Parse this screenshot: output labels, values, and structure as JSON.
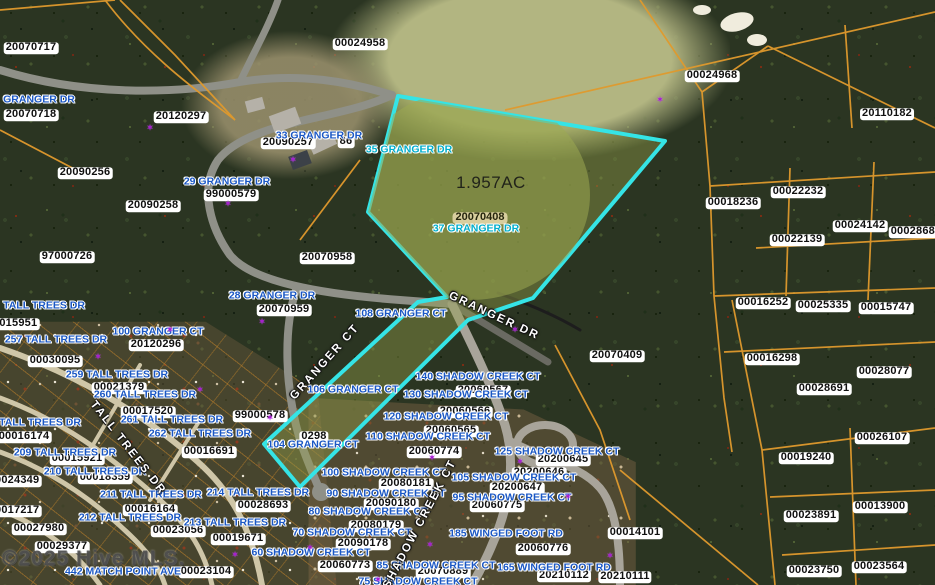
{
  "map": {
    "watermark": "©2025 Hive MLS.",
    "subject_parcel": {
      "id": "20070408",
      "address": "37 GRANGER DR",
      "area": "1.957AC",
      "id_x": 480,
      "id_y": 218,
      "addr_x": 476,
      "addr_y": 229,
      "area_x": 491,
      "area_y": 183
    },
    "colors": {
      "subject_boundary": "#35e4e6",
      "subject_id_pill": "#d8ce9e",
      "parcel_lines": "#e09a2d",
      "address_text": "#1a57c4",
      "teal_address_text": "#00aecc",
      "marker": "#a81ad2"
    },
    "icons": {
      "marker": "✶"
    },
    "parcel_labels": [
      {
        "t": "20070717",
        "x": 31,
        "y": 48
      },
      {
        "t": "00024958",
        "x": 360,
        "y": 44
      },
      {
        "t": "00024968",
        "x": 712,
        "y": 76
      },
      {
        "t": "20110182",
        "x": 887,
        "y": 114
      },
      {
        "t": "20070718",
        "x": 31,
        "y": 115
      },
      {
        "t": "20120297",
        "x": 181,
        "y": 117
      },
      {
        "t": "20090257",
        "x": 288,
        "y": 143
      },
      {
        "t": "86",
        "x": 346,
        "y": 142
      },
      {
        "t": "20090256",
        "x": 85,
        "y": 173
      },
      {
        "t": "20090258",
        "x": 153,
        "y": 206
      },
      {
        "t": "99000579",
        "x": 231,
        "y": 195
      },
      {
        "t": "97000726",
        "x": 67,
        "y": 257
      },
      {
        "t": "00022232",
        "x": 798,
        "y": 192
      },
      {
        "t": "00018236",
        "x": 733,
        "y": 203
      },
      {
        "t": "00024142",
        "x": 860,
        "y": 226
      },
      {
        "t": "00028689",
        "x": 916,
        "y": 232
      },
      {
        "t": "00022139",
        "x": 797,
        "y": 240
      },
      {
        "t": "20070958",
        "x": 327,
        "y": 258
      },
      {
        "t": "20070959",
        "x": 284,
        "y": 310
      },
      {
        "t": "00016252",
        "x": 763,
        "y": 303
      },
      {
        "t": "00025335",
        "x": 823,
        "y": 306
      },
      {
        "t": "00015747",
        "x": 886,
        "y": 308
      },
      {
        "t": "00015951",
        "x": 12,
        "y": 324
      },
      {
        "t": "20120296",
        "x": 156,
        "y": 345
      },
      {
        "t": "00030095",
        "x": 55,
        "y": 361
      },
      {
        "t": "20070409",
        "x": 617,
        "y": 356
      },
      {
        "t": "00016298",
        "x": 772,
        "y": 359
      },
      {
        "t": "00028077",
        "x": 884,
        "y": 372
      },
      {
        "t": "00021379",
        "x": 119,
        "y": 388
      },
      {
        "t": "00028691",
        "x": 824,
        "y": 389
      },
      {
        "t": "20060567",
        "x": 483,
        "y": 391
      },
      {
        "t": "00017520",
        "x": 148,
        "y": 412
      },
      {
        "t": "20060566",
        "x": 465,
        "y": 412
      },
      {
        "t": "99000578",
        "x": 260,
        "y": 416
      },
      {
        "t": "20060565",
        "x": 451,
        "y": 431
      },
      {
        "t": "0298",
        "x": 314,
        "y": 437
      },
      {
        "t": "00016174",
        "x": 24,
        "y": 437
      },
      {
        "t": "00026107",
        "x": 882,
        "y": 438
      },
      {
        "t": "20060774",
        "x": 434,
        "y": 452
      },
      {
        "t": "00016691",
        "x": 209,
        "y": 452
      },
      {
        "t": "00019240",
        "x": 806,
        "y": 458
      },
      {
        "t": "20200645",
        "x": 563,
        "y": 460
      },
      {
        "t": "00015921",
        "x": 77,
        "y": 459
      },
      {
        "t": "20200646",
        "x": 539,
        "y": 473
      },
      {
        "t": "00018359",
        "x": 105,
        "y": 478
      },
      {
        "t": "00024349",
        "x": 14,
        "y": 481
      },
      {
        "t": "20080181",
        "x": 406,
        "y": 484
      },
      {
        "t": "20200647",
        "x": 517,
        "y": 488
      },
      {
        "t": "20090180",
        "x": 391,
        "y": 504
      },
      {
        "t": "20060775",
        "x": 497,
        "y": 506
      },
      {
        "t": "00028693",
        "x": 263,
        "y": 506
      },
      {
        "t": "00013900",
        "x": 880,
        "y": 507
      },
      {
        "t": "00016164",
        "x": 150,
        "y": 510
      },
      {
        "t": "00017217",
        "x": 14,
        "y": 511
      },
      {
        "t": "00023891",
        "x": 811,
        "y": 516
      },
      {
        "t": "20080179",
        "x": 376,
        "y": 526
      },
      {
        "t": "00027980",
        "x": 39,
        "y": 529
      },
      {
        "t": "00023056",
        "x": 178,
        "y": 531
      },
      {
        "t": "00014101",
        "x": 635,
        "y": 533
      },
      {
        "t": "00019671",
        "x": 238,
        "y": 539
      },
      {
        "t": "20090178",
        "x": 363,
        "y": 544
      },
      {
        "t": "00029377",
        "x": 62,
        "y": 547
      },
      {
        "t": "20060776",
        "x": 543,
        "y": 549
      },
      {
        "t": "20060773",
        "x": 345,
        "y": 566
      },
      {
        "t": "00023564",
        "x": 879,
        "y": 567
      },
      {
        "t": "00023750",
        "x": 814,
        "y": 571
      },
      {
        "t": "20070889",
        "x": 443,
        "y": 572
      },
      {
        "t": "00023104",
        "x": 206,
        "y": 572
      },
      {
        "t": "20210112",
        "x": 564,
        "y": 576
      },
      {
        "t": "20210111",
        "x": 625,
        "y": 577
      }
    ],
    "address_labels": [
      {
        "t": "GRANGER DR",
        "x": 39,
        "y": 100
      },
      {
        "t": "33 GRANGER DR",
        "x": 319,
        "y": 136
      },
      {
        "t": "35 GRANGER DR",
        "x": 409,
        "y": 150,
        "teal": true
      },
      {
        "t": "29 GRANGER DR",
        "x": 227,
        "y": 182
      },
      {
        "t": "28 GRANGER DR",
        "x": 272,
        "y": 296
      },
      {
        "t": "TALL TREES DR",
        "x": 44,
        "y": 306
      },
      {
        "t": "108 GRANGER CT",
        "x": 401,
        "y": 314
      },
      {
        "t": "100 GRANGER CT",
        "x": 158,
        "y": 332
      },
      {
        "t": "257 TALL TREES DR",
        "x": 56,
        "y": 340
      },
      {
        "t": "259 TALL TREES DR",
        "x": 117,
        "y": 375
      },
      {
        "t": "140 SHADOW CREEK CT",
        "x": 478,
        "y": 377
      },
      {
        "t": "106 GRANGER CT",
        "x": 353,
        "y": 390
      },
      {
        "t": "260 TALL TREES DR",
        "x": 145,
        "y": 395
      },
      {
        "t": "130 SHADOW CREEK CT",
        "x": 466,
        "y": 395
      },
      {
        "t": "120 SHADOW CREEK CT",
        "x": 446,
        "y": 417
      },
      {
        "t": "261 TALL TREES DR",
        "x": 172,
        "y": 420
      },
      {
        "t": "TALL TREES DR",
        "x": 40,
        "y": 423
      },
      {
        "t": "262 TALL TREES DR",
        "x": 200,
        "y": 434
      },
      {
        "t": "110 SHADOW CREEK CT",
        "x": 428,
        "y": 437
      },
      {
        "t": "104 GRANGER CT",
        "x": 313,
        "y": 445
      },
      {
        "t": "125 SHADOW CREEK CT",
        "x": 557,
        "y": 452
      },
      {
        "t": "209 TALL TREES DR",
        "x": 65,
        "y": 453
      },
      {
        "t": "210 TALL TREES DR",
        "x": 95,
        "y": 472
      },
      {
        "t": "100 SHADOW CREEK CT",
        "x": 384,
        "y": 473
      },
      {
        "t": "105 SHADOW CREEK CT",
        "x": 514,
        "y": 478
      },
      {
        "t": "214 TALL TREES DR",
        "x": 258,
        "y": 493
      },
      {
        "t": "90 SHADOW CREEK CT",
        "x": 386,
        "y": 494
      },
      {
        "t": "211 TALL TREES DR",
        "x": 151,
        "y": 495
      },
      {
        "t": "95 SHADOW CREEK CT",
        "x": 512,
        "y": 498
      },
      {
        "t": "80 SHADOW CREEK CT",
        "x": 368,
        "y": 512
      },
      {
        "t": "212 TALL TREES DR",
        "x": 130,
        "y": 518
      },
      {
        "t": "213 TALL TREES DR",
        "x": 235,
        "y": 523
      },
      {
        "t": "70 SHADOW CREEK CT",
        "x": 352,
        "y": 533
      },
      {
        "t": "185 WINGED FOOT RD",
        "x": 506,
        "y": 534
      },
      {
        "t": "60 SHADOW CREEK CT",
        "x": 311,
        "y": 553
      },
      {
        "t": "85 SHADOW CREEK CT",
        "x": 436,
        "y": 566
      },
      {
        "t": "165 WINGED FOOT RD",
        "x": 554,
        "y": 568
      },
      {
        "t": "442 MATCH POINT AVE",
        "x": 123,
        "y": 572
      },
      {
        "t": "75 SHADOW CREEK CT",
        "x": 418,
        "y": 582
      }
    ],
    "street_labels": [
      {
        "t": "GRANGER DR",
        "x": 494,
        "y": 316,
        "a": 25
      },
      {
        "t": "GRANGER CT",
        "x": 325,
        "y": 362,
        "a": -48
      },
      {
        "t": "TALL TREES DR",
        "x": 128,
        "y": 448,
        "a": 52
      },
      {
        "t": "SHADOW CREEK CT",
        "x": 420,
        "y": 524,
        "a": -62
      }
    ],
    "markers": [
      [
        150,
        128
      ],
      [
        293,
        160
      ],
      [
        228,
        204
      ],
      [
        660,
        100
      ],
      [
        515,
        330
      ],
      [
        170,
        330
      ],
      [
        262,
        322
      ],
      [
        98,
        357
      ],
      [
        200,
        390
      ],
      [
        270,
        418
      ],
      [
        432,
        458
      ],
      [
        520,
        462
      ],
      [
        568,
        497
      ],
      [
        610,
        556
      ],
      [
        235,
        555
      ],
      [
        310,
        548
      ],
      [
        430,
        545
      ],
      [
        378,
        580
      ]
    ]
  }
}
